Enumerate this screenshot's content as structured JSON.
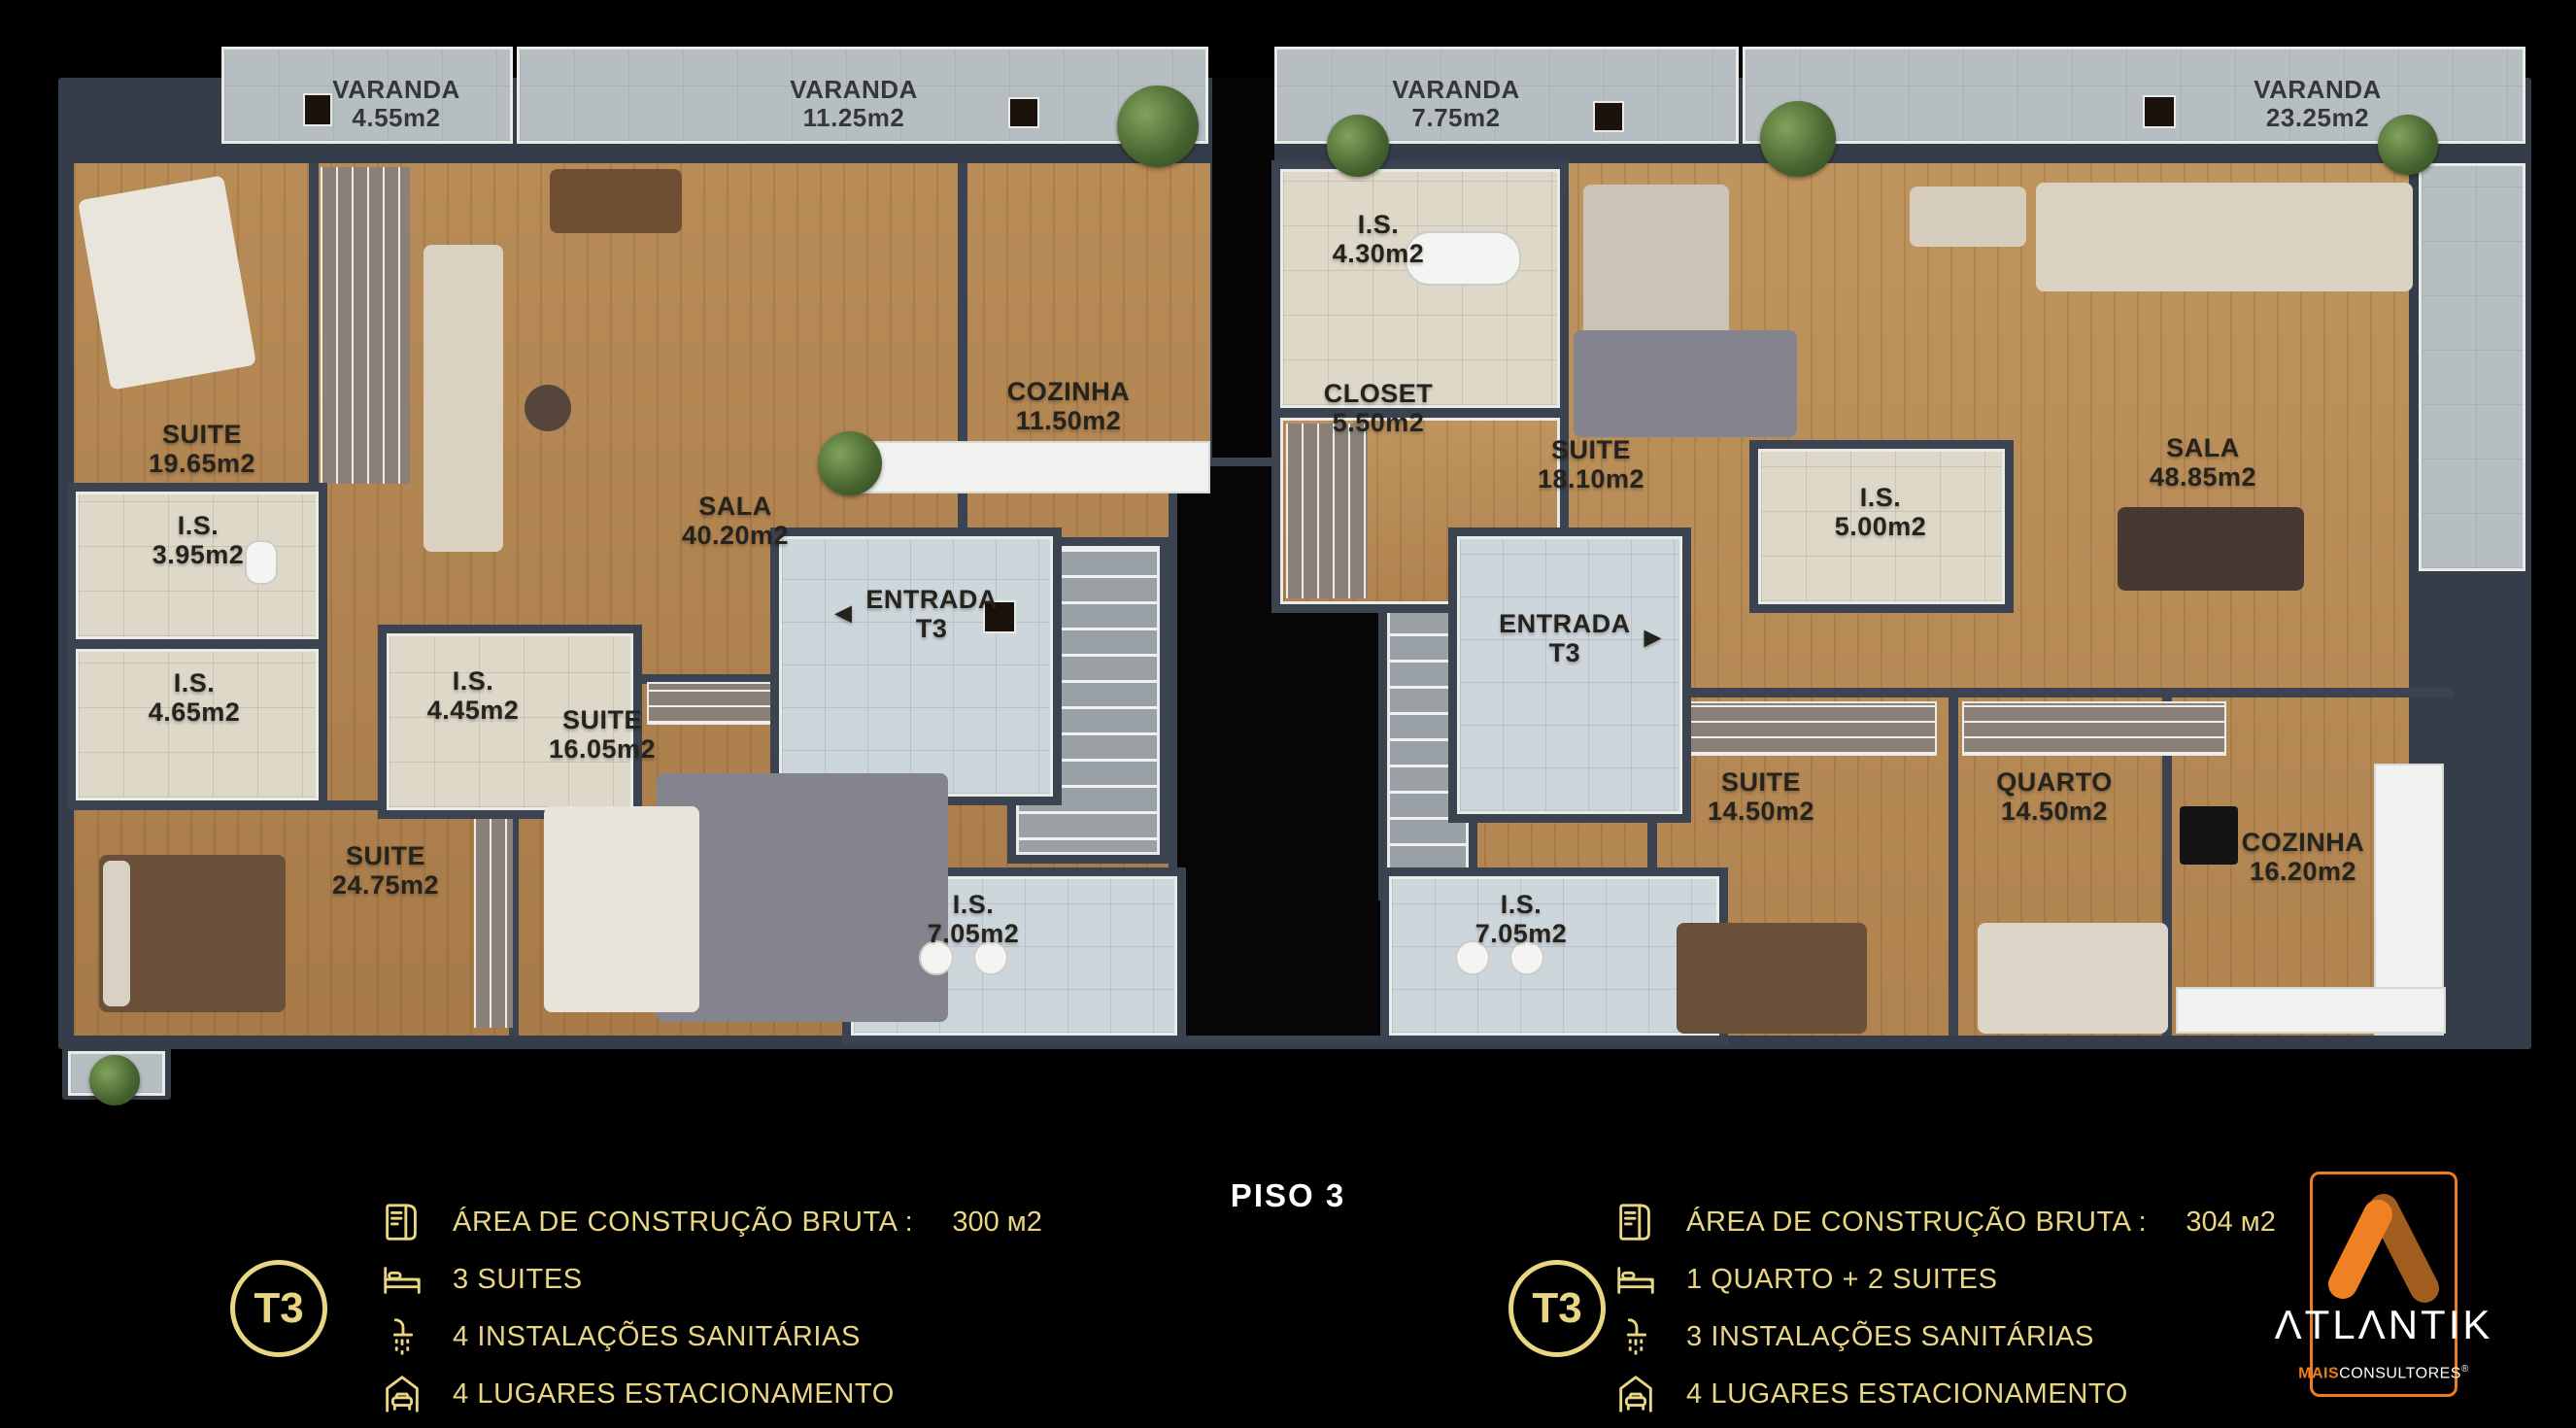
{
  "title": {
    "text": "PISO 3"
  },
  "icons": {
    "arrow_left": "◄",
    "arrow_right": "►"
  },
  "plan": {
    "varandas": [
      {
        "name": "VARANDA",
        "area": "4.55m2"
      },
      {
        "name": "VARANDA",
        "area": "11.25m2"
      },
      {
        "name": "VARANDA",
        "area": "7.75m2"
      },
      {
        "name": "VARANDA",
        "area": "23.25m2"
      }
    ],
    "left_rooms": [
      {
        "name": "SUITE",
        "area": "19.65m2"
      },
      {
        "name": "I.S.",
        "area": "3.95m2"
      },
      {
        "name": "I.S.",
        "area": "4.65m2"
      },
      {
        "name": "I.S.",
        "area": "4.45m2"
      },
      {
        "name": "SUITE",
        "area": "16.05m2"
      },
      {
        "name": "SUITE",
        "area": "24.75m2"
      },
      {
        "name": "SALA",
        "area": "40.20m2"
      },
      {
        "name": "COZINHA",
        "area": "11.50m2"
      },
      {
        "name": "I.S.",
        "area": "7.05m2"
      }
    ],
    "left_entrance": {
      "line1": "ENTRADA",
      "line2": "T3"
    },
    "right_rooms": [
      {
        "name": "I.S.",
        "area": "4.30m2"
      },
      {
        "name": "CLOSET",
        "area": "5.50m2"
      },
      {
        "name": "SUITE",
        "area": "18.10m2"
      },
      {
        "name": "I.S.",
        "area": "5.00m2"
      },
      {
        "name": "SALA",
        "area": "48.85m2"
      },
      {
        "name": "SUITE",
        "area": "14.50m2"
      },
      {
        "name": "QUARTO",
        "area": "14.50m2"
      },
      {
        "name": "COZINHA",
        "area": "16.20m2"
      },
      {
        "name": "I.S.",
        "area": "7.05m2"
      }
    ],
    "right_entrance": {
      "line1": "ENTRADA",
      "line2": "T3"
    }
  },
  "legend_left": {
    "badge": "T3",
    "items": [
      {
        "icon": "blueprint-icon",
        "label": "ÁREA DE CONSTRUÇÃO BRUTA :",
        "value": "300 м2"
      },
      {
        "icon": "bed-icon",
        "label": "3 SUITES"
      },
      {
        "icon": "shower-icon",
        "label": "4 INSTALAÇÕES SANITÁRIAS"
      },
      {
        "icon": "car-icon",
        "label": "4 LUGARES ESTACIONAMENTO"
      }
    ]
  },
  "legend_right": {
    "badge": "T3",
    "items": [
      {
        "icon": "blueprint-icon",
        "label": "ÁREA DE CONSTRUÇÃO BRUTA :",
        "value": "304 м2"
      },
      {
        "icon": "bed-icon",
        "label": "1 QUARTO + 2 SUITES"
      },
      {
        "icon": "shower-icon",
        "label": "3 INSTALAÇÕES SANITÁRIAS"
      },
      {
        "icon": "car-icon",
        "label": "4 LUGARES ESTACIONAMENTO"
      }
    ]
  },
  "brand": {
    "name": "ATLANTIK",
    "name_display": "ΛTLΛNTIK",
    "sub_bold": "MAIS",
    "sub": "CONSULTORES",
    "reg": "®"
  },
  "colors": {
    "accent_gold": "#e9d684",
    "brand_orange": "#ef7d1e",
    "brand_orange_dark": "#a05d1e",
    "wall": "#3a434f",
    "wood": "#b08350",
    "background": "#000000"
  }
}
